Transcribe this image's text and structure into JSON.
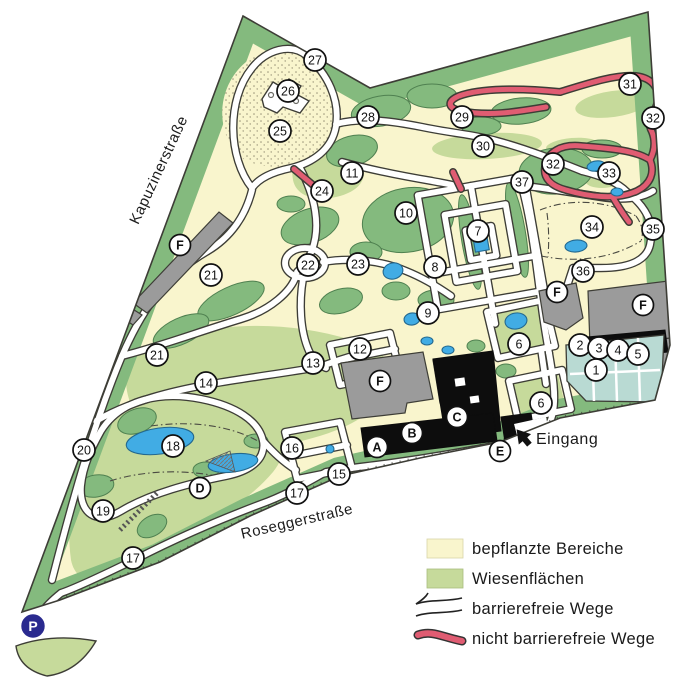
{
  "colors": {
    "planted": "#f9f5cd",
    "meadow": "#c6da9b",
    "forest": "#84ba7e",
    "forest_line": "#4f8050",
    "line": "#3d3d36",
    "pond": "#41ace4",
    "redpath": "#e05c72",
    "building_gray": "#9b9b9b",
    "building_black": "#0d0d0d",
    "greenhouse": "#b9dad3",
    "parking_blue": "#2a2a8f"
  },
  "streets": [
    {
      "name": "Kapuzinerstraße",
      "x": 163,
      "y": 172,
      "angle": -65
    },
    {
      "name": "Roseggerstraße",
      "x": 298,
      "y": 526,
      "angle": -13
    }
  ],
  "entrance": {
    "label": "Eingang",
    "x": 536,
    "y": 444
  },
  "parking": {
    "label": "P",
    "x": 33,
    "y": 626
  },
  "markers": [
    {
      "label": "1",
      "x": 596,
      "y": 370
    },
    {
      "label": "2",
      "x": 580,
      "y": 345
    },
    {
      "label": "3",
      "x": 599,
      "y": 348
    },
    {
      "label": "4",
      "x": 618,
      "y": 350
    },
    {
      "label": "5",
      "x": 638,
      "y": 354
    },
    {
      "label": "6",
      "x": 519,
      "y": 344
    },
    {
      "label": "6",
      "x": 541,
      "y": 403
    },
    {
      "label": "7",
      "x": 478,
      "y": 231
    },
    {
      "label": "8",
      "x": 435,
      "y": 267
    },
    {
      "label": "9",
      "x": 428,
      "y": 313
    },
    {
      "label": "10",
      "x": 406,
      "y": 213
    },
    {
      "label": "11",
      "x": 352,
      "y": 173
    },
    {
      "label": "12",
      "x": 360,
      "y": 349
    },
    {
      "label": "13",
      "x": 313,
      "y": 363
    },
    {
      "label": "14",
      "x": 206,
      "y": 383
    },
    {
      "label": "15",
      "x": 339,
      "y": 474
    },
    {
      "label": "16",
      "x": 292,
      "y": 448
    },
    {
      "label": "17",
      "x": 297,
      "y": 493
    },
    {
      "label": "17",
      "x": 133,
      "y": 558
    },
    {
      "label": "18",
      "x": 173,
      "y": 446
    },
    {
      "label": "19",
      "x": 103,
      "y": 511
    },
    {
      "label": "20",
      "x": 84,
      "y": 450
    },
    {
      "label": "21",
      "x": 211,
      "y": 275
    },
    {
      "label": "21",
      "x": 157,
      "y": 355
    },
    {
      "label": "22",
      "x": 308,
      "y": 265
    },
    {
      "label": "23",
      "x": 358,
      "y": 264
    },
    {
      "label": "24",
      "x": 322,
      "y": 191
    },
    {
      "label": "25",
      "x": 280,
      "y": 131
    },
    {
      "label": "26",
      "x": 288,
      "y": 91
    },
    {
      "label": "27",
      "x": 315,
      "y": 60
    },
    {
      "label": "28",
      "x": 368,
      "y": 117
    },
    {
      "label": "29",
      "x": 462,
      "y": 117
    },
    {
      "label": "30",
      "x": 483,
      "y": 146
    },
    {
      "label": "31",
      "x": 630,
      "y": 84
    },
    {
      "label": "32",
      "x": 553,
      "y": 164
    },
    {
      "label": "32",
      "x": 653,
      "y": 118
    },
    {
      "label": "33",
      "x": 609,
      "y": 173
    },
    {
      "label": "34",
      "x": 592,
      "y": 227
    },
    {
      "label": "35",
      "x": 653,
      "y": 229
    },
    {
      "label": "36",
      "x": 583,
      "y": 271
    },
    {
      "label": "37",
      "x": 522,
      "y": 182
    }
  ],
  "letters": [
    {
      "label": "A",
      "x": 377,
      "y": 447
    },
    {
      "label": "B",
      "x": 412,
      "y": 433
    },
    {
      "label": "C",
      "x": 457,
      "y": 417
    },
    {
      "label": "D",
      "x": 200,
      "y": 488
    },
    {
      "label": "E",
      "x": 500,
      "y": 451
    },
    {
      "label": "F",
      "x": 180,
      "y": 245
    },
    {
      "label": "F",
      "x": 380,
      "y": 381
    },
    {
      "label": "F",
      "x": 557,
      "y": 292
    },
    {
      "label": "F",
      "x": 643,
      "y": 305
    }
  ],
  "legend": {
    "items": [
      {
        "swatch": "planted",
        "label": "bepflanzte Bereiche"
      },
      {
        "swatch": "meadow",
        "label": "Wiesenflächen"
      },
      {
        "swatch": "path",
        "label": "barrierefreie Wege"
      },
      {
        "swatch": "redpath",
        "label": "nicht barrierefreie Wege"
      }
    ]
  }
}
